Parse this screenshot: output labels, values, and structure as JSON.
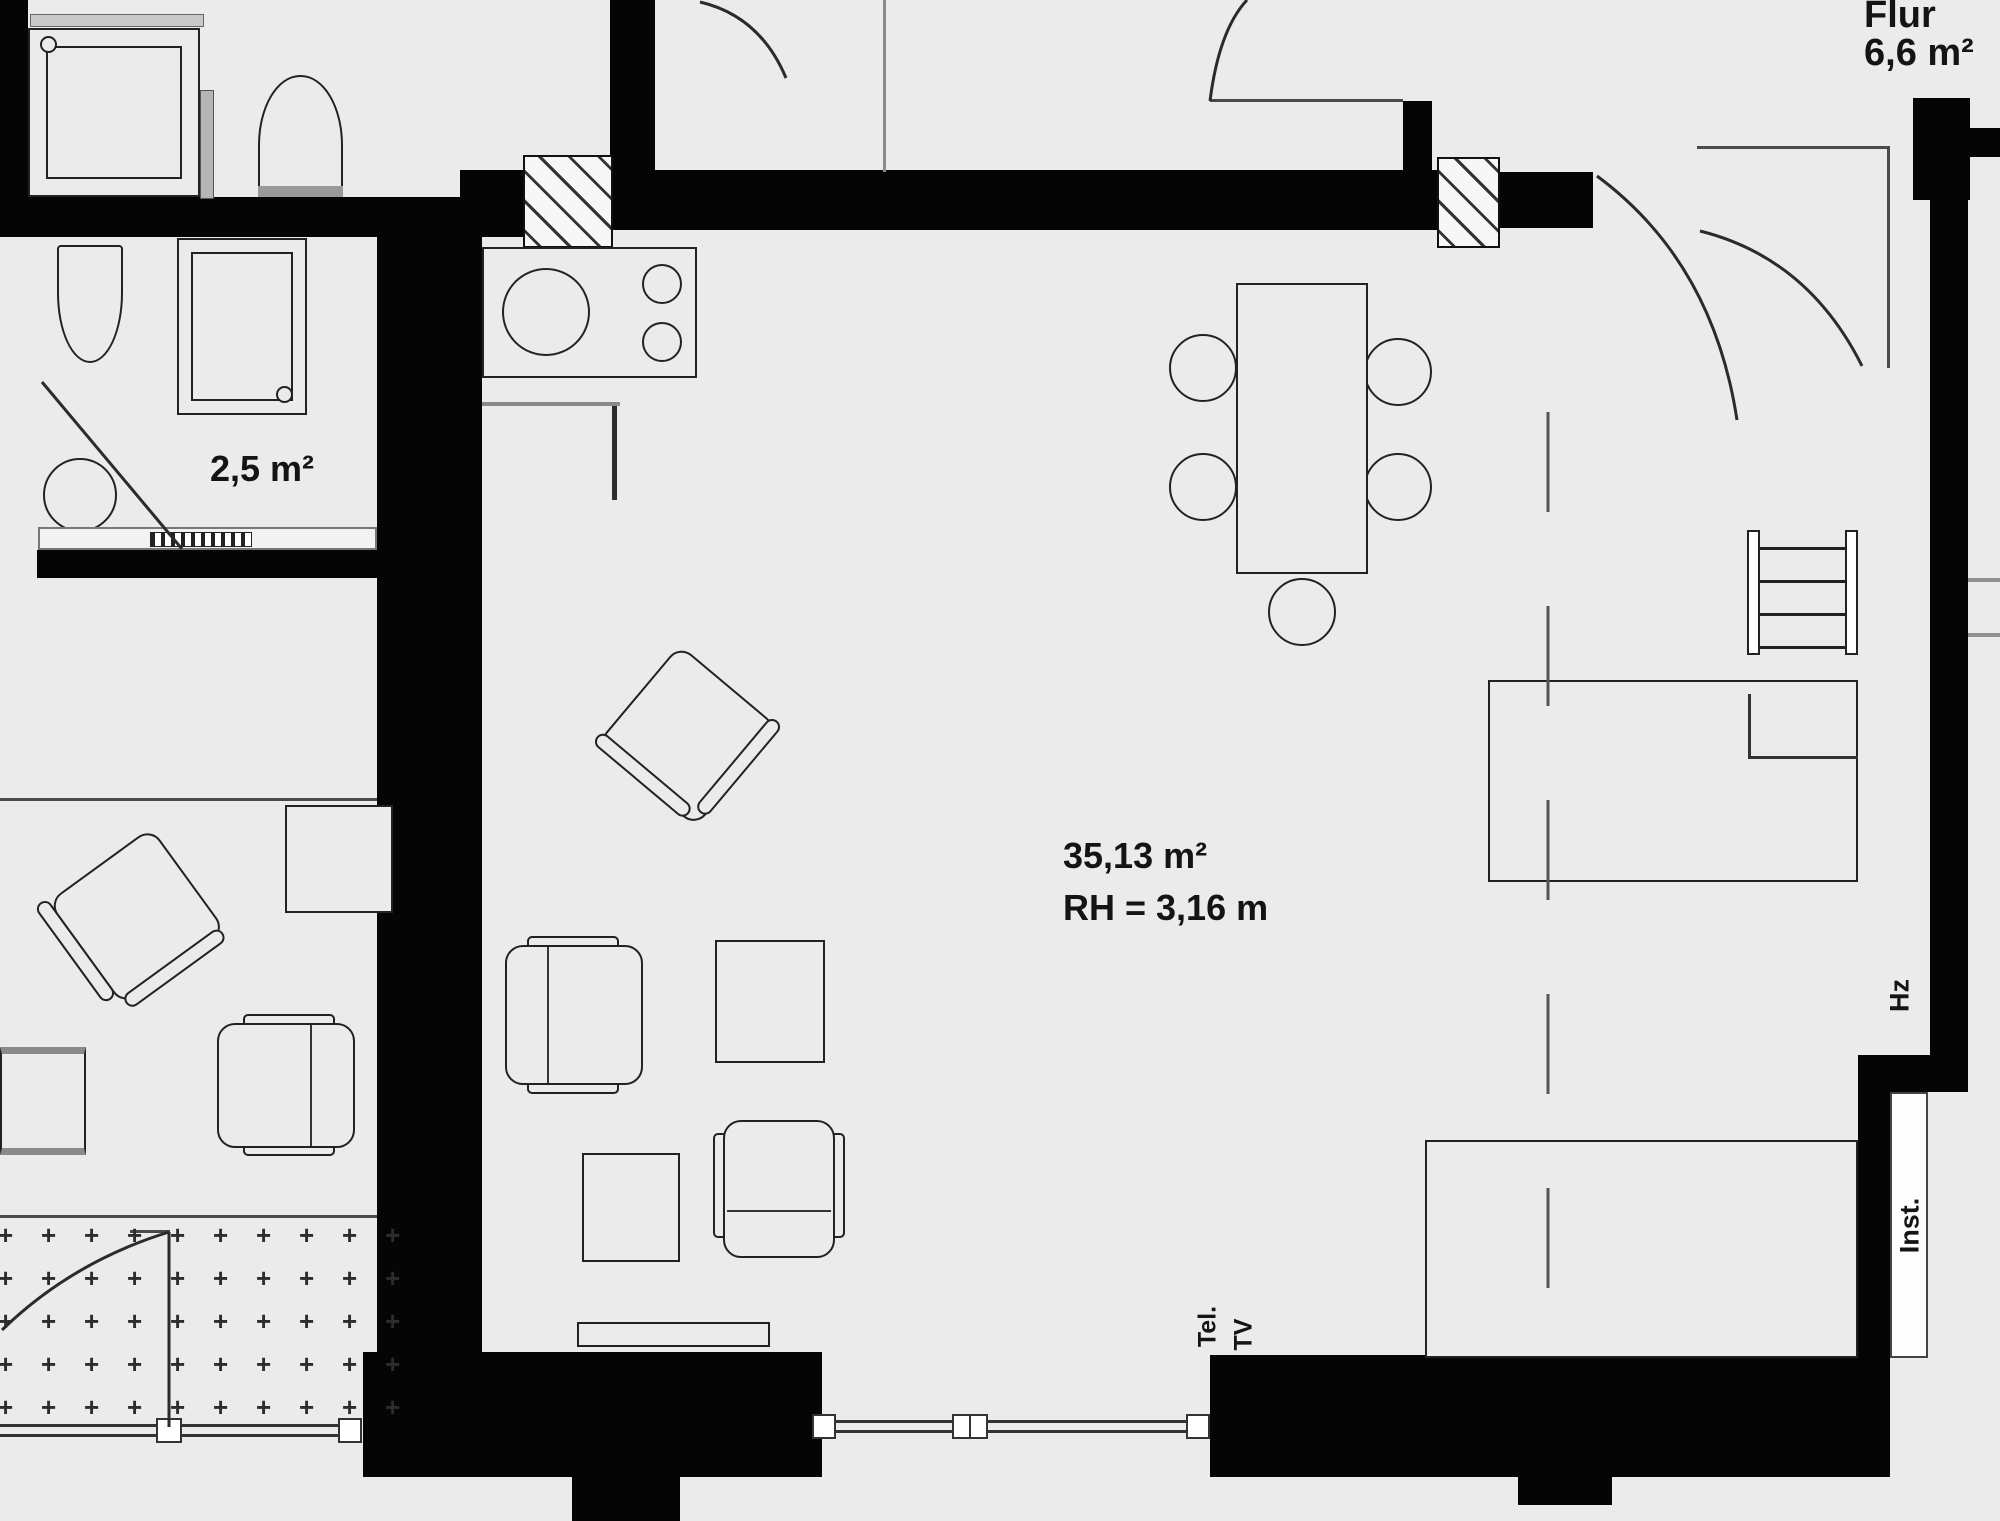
{
  "title": "Apartment floor plan",
  "labels": {
    "hall_name": "Flur",
    "hall_area": "6,6 m²",
    "bath_area": "2,5 m²",
    "living_area": "35,13 m²",
    "living_height": "RH = 3,16 m",
    "heating": "Hz",
    "installation": "Inst.",
    "telephone": "Tel.",
    "tv": "TV",
    "balcony_marker": "+"
  },
  "rooms": [
    {
      "name": "Flur",
      "area_m2": "6,6"
    },
    {
      "name": "Bad",
      "area_m2": "2,5"
    },
    {
      "name": "Wohnraum",
      "area_m2": "35,13",
      "clear_height_m": "3,16"
    }
  ],
  "colors": {
    "background": "#ebebeb",
    "wall": "#050505",
    "line": "#2b2b2b"
  }
}
